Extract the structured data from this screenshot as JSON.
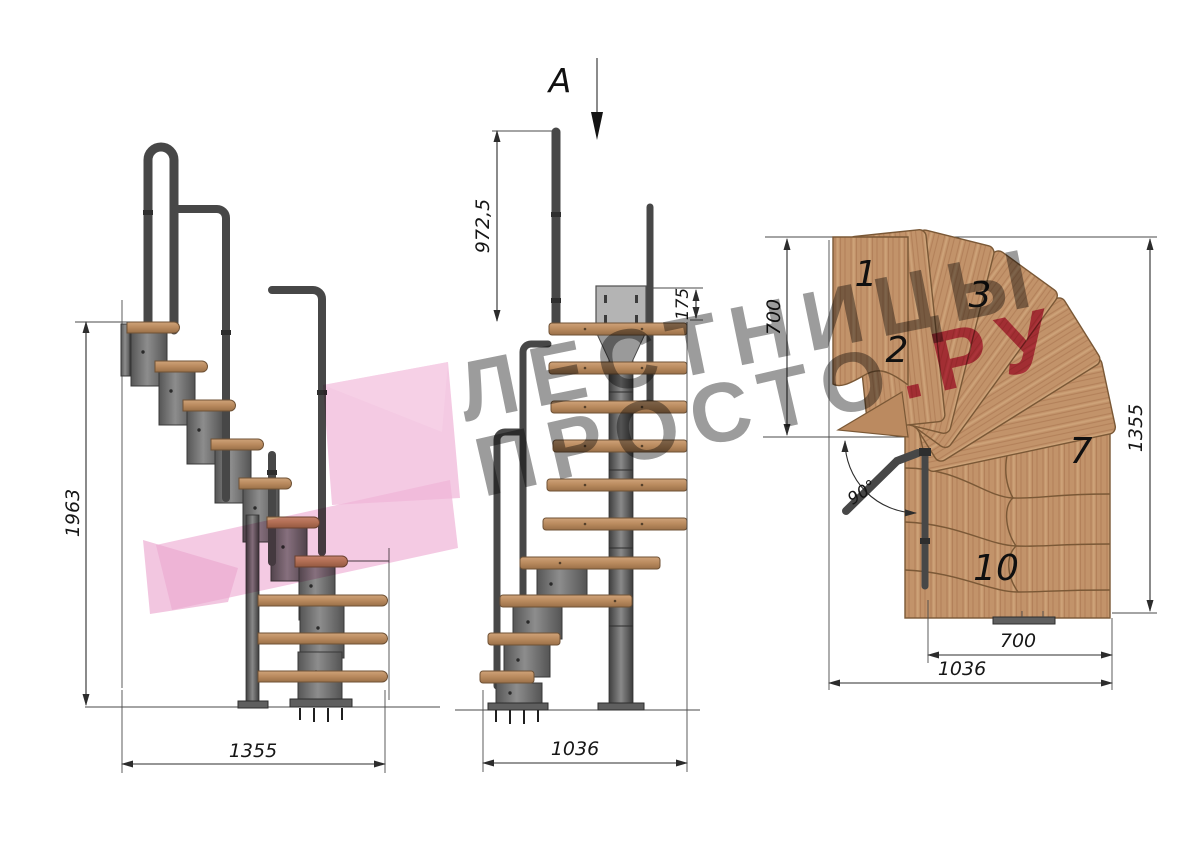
{
  "section": {
    "label": "A"
  },
  "views": {
    "side": {
      "title": "side-elevation",
      "height": "1963",
      "width": "1355"
    },
    "front": {
      "title": "front-elevation",
      "rail_height": "972,5",
      "bracket_height": "175",
      "width": "1036"
    },
    "plan": {
      "title": "top-plan",
      "upper_depth": "700",
      "total_depth": "1355",
      "run_width": "700",
      "total_width": "1036",
      "turn_angle": "90°",
      "steps": {
        "n1": "1",
        "n2": "2",
        "n3": "3",
        "n7": "7",
        "n10": "10"
      }
    }
  },
  "watermark": {
    "line1": "ЛЕСТНИЦЫ",
    "line2_gray": "ПРОСТО",
    "line2_accent": ".РУ"
  },
  "colors": {
    "wood": "#c2936a",
    "wood_edge": "#7a5836",
    "metal": "#6d6d6d",
    "tube": "#474747",
    "dim_line": "#2c2c2c",
    "watermark_gray": "#9c9c9c",
    "watermark_accent": "#d5507a",
    "logo_pink": "#f0b5d8"
  }
}
